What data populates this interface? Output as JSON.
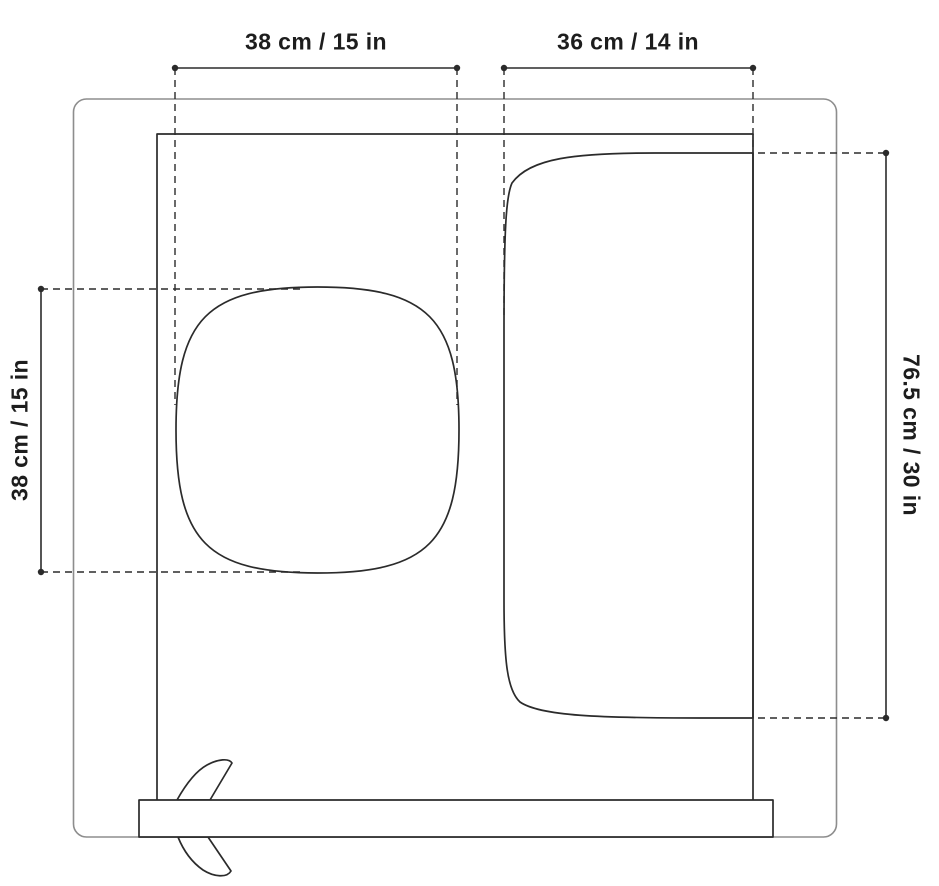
{
  "diagram": {
    "description": "Top-view product dimension drawing with basin, mat area, front rail and lever",
    "colors": {
      "background": "#ffffff",
      "line": "#2b2b2b",
      "outer_line": "#8d8d8d",
      "text": "#1d1d1d"
    },
    "dimensions": [
      {
        "id": "basin-width",
        "label": "38 cm / 15 in",
        "cm": 38,
        "in": 15,
        "orientation": "horizontal",
        "position": "top-left"
      },
      {
        "id": "mat-width",
        "label": "36 cm / 14 in",
        "cm": 36,
        "in": 14,
        "orientation": "horizontal",
        "position": "top-right"
      },
      {
        "id": "basin-height",
        "label": "38 cm / 15 in",
        "cm": 38,
        "in": 15,
        "orientation": "vertical",
        "position": "left"
      },
      {
        "id": "mat-height",
        "label": "76.5 cm / 30 in",
        "cm": 76.5,
        "in": 30,
        "orientation": "vertical",
        "position": "right"
      }
    ]
  }
}
